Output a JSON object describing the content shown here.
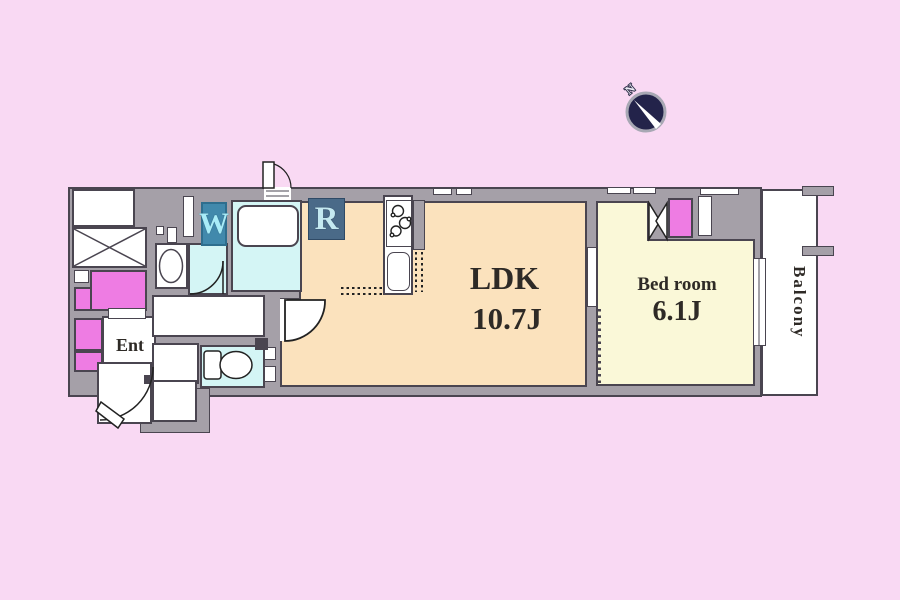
{
  "palette": {
    "bg": "#F9D9F3",
    "wall": "#A5A0A8",
    "line": "#4A4550",
    "water": "#D4F5F5",
    "ldk_floor": "#FBE2BD",
    "bedroom_floor": "#FAF8D8",
    "closet": "#EE7CE3",
    "washer_bg": "#4189AC",
    "washer_text": "#A8ECF8",
    "fridge_bg": "#4A6A88",
    "fridge_text": "#C4E9F1",
    "compass_bg": "#23234A",
    "ink": "#2E2A26"
  },
  "rooms": {
    "ldk": {
      "label": "LDK",
      "size": "10.7J"
    },
    "bedroom": {
      "label": "Bed room",
      "size": "6.1J"
    },
    "entrance": {
      "label": "Ent"
    },
    "balcony": {
      "label": "Balcony"
    }
  },
  "appliances": {
    "washer": "W",
    "refrigerator": "R"
  },
  "compass": {
    "north": "N"
  }
}
